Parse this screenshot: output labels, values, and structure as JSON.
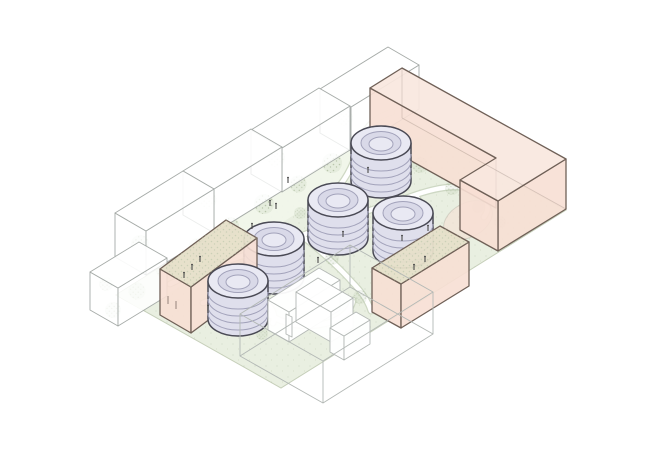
{
  "meta": {
    "title": "Axonometric site massing diagram with five cylindrical tanks",
    "type": "architectural-diagram",
    "view": "axonometric"
  },
  "colors": {
    "background": "#ffffff",
    "ground": "#e9efe1",
    "ground-light": "#f2f6eb",
    "ground-dot": "#9fb292",
    "ground-edge": "#c6cfba",
    "path": "#ffffff",
    "path-edge": "#ccd6c2",
    "context-fill": "#ffffff",
    "context-outline": "#a6aba8",
    "wire": "#b3b8b5",
    "accent-top": "#f8e7de",
    "accent-side": "#f7dfd4",
    "accent-outline": "#6f6057",
    "roof-tan": "#e6dfc9",
    "tree": "#b4c2a6",
    "figure": "#4a4a4a",
    "cylinder-top": "#e9e9f3",
    "cylinder-band": "#d9d9e8",
    "cylinder-body": "#dfdfec",
    "cylinder-outline": "#4a4a55",
    "cylinder-line": "#a2a2ba"
  },
  "scene": {
    "site_shape": "rectangular block seen in axonometric",
    "tanks": {
      "count": 5,
      "form": "ribbed cylindrical silos with circular rim on top",
      "color_role": "lavender"
    },
    "proposed_buildings": [
      {
        "name": "l-shaped-perimeter-building",
        "position": "north-east edge",
        "roof": "pink"
      },
      {
        "name": "linear-building",
        "position": "south-east side",
        "roof": "tan planted"
      },
      {
        "name": "corner-block-building",
        "position": "south-west corner",
        "roof": "tan planted"
      }
    ],
    "context_buildings": {
      "count": 5,
      "style": "white semi-transparent volumes with trees behind",
      "position": "north-west edge"
    },
    "wireframe_building": {
      "position": "south corner",
      "style": "transparent outline box with white interior walls"
    },
    "courtyard": {
      "ground": "lawn with dotted planting texture",
      "paths": "white curved walkways",
      "trees": true,
      "figures": true
    }
  }
}
